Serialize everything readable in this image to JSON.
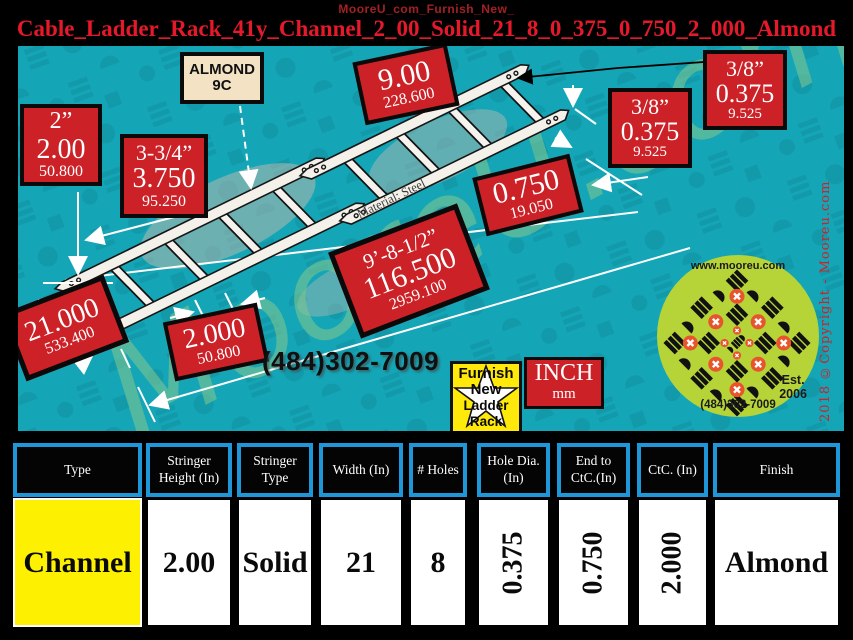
{
  "header": {
    "subtitle": "MooreU_com_Furnish_New_",
    "title": "Cable_Ladder_Rack_41y_Channel_2_00_Solid_21_8_0_375_0_750_2_000_Almond"
  },
  "drawing": {
    "almond_tag": {
      "line1": "ALMOND",
      "line2": "9C"
    },
    "boxes": {
      "stringer_height": {
        "l1": "2”",
        "l2": "2.00",
        "l3": "50.800"
      },
      "rung_spacing": {
        "l1": "3-3/4”",
        "l2": "3.750",
        "l3": "95.250"
      },
      "end_spacing": {
        "l1": "9.00",
        "l2": "228.600"
      },
      "hole_dia_top": {
        "l1": "3/8”",
        "l2": "0.375",
        "l3": "9.525"
      },
      "hole_dia_mid": {
        "l1": "3/8”",
        "l2": "0.375",
        "l3": "9.525"
      },
      "end_to_ctc": {
        "l1": "0.750",
        "l2": "19.050"
      },
      "overall_length": {
        "l1": "9’-8-1/2”",
        "l2": "116.500",
        "l3": "2959.100"
      },
      "width": {
        "l1": "21.000",
        "l2": "533.400"
      },
      "ctc": {
        "l1": "2.000",
        "l2": "50.800"
      }
    },
    "material_note": "Material: Steel",
    "phone": "(484)302-7009",
    "star_tag": {
      "l1": "Furnish",
      "l2": "New",
      "l3": "Ladder",
      "l4": "Rack"
    },
    "units_tag": {
      "l1": "INCH",
      "l2": "mm"
    },
    "watermark": "MooreU.com",
    "copyright": "2018 ©Copyright - Mooreu.com",
    "logo": {
      "url": "www.mooreu.com",
      "est_line1": "Est.",
      "est_line2": "2006",
      "phone": "(484)302-7009"
    }
  },
  "table": {
    "columns": [
      {
        "header": "Type",
        "value": "Channel"
      },
      {
        "header": "Stringer Height (In)",
        "value": "2.00"
      },
      {
        "header": "Stringer Type",
        "value": "Solid"
      },
      {
        "header": "Width (In)",
        "value": "21"
      },
      {
        "header": "# Holes",
        "value": "8"
      },
      {
        "header": "Hole Dia. (In)",
        "value": "0.375"
      },
      {
        "header": "End to CtC.(In)",
        "value": "0.750"
      },
      {
        "header": "CtC. (In)",
        "value": "2.000"
      },
      {
        "header": "Finish",
        "value": "Almond"
      }
    ]
  }
}
